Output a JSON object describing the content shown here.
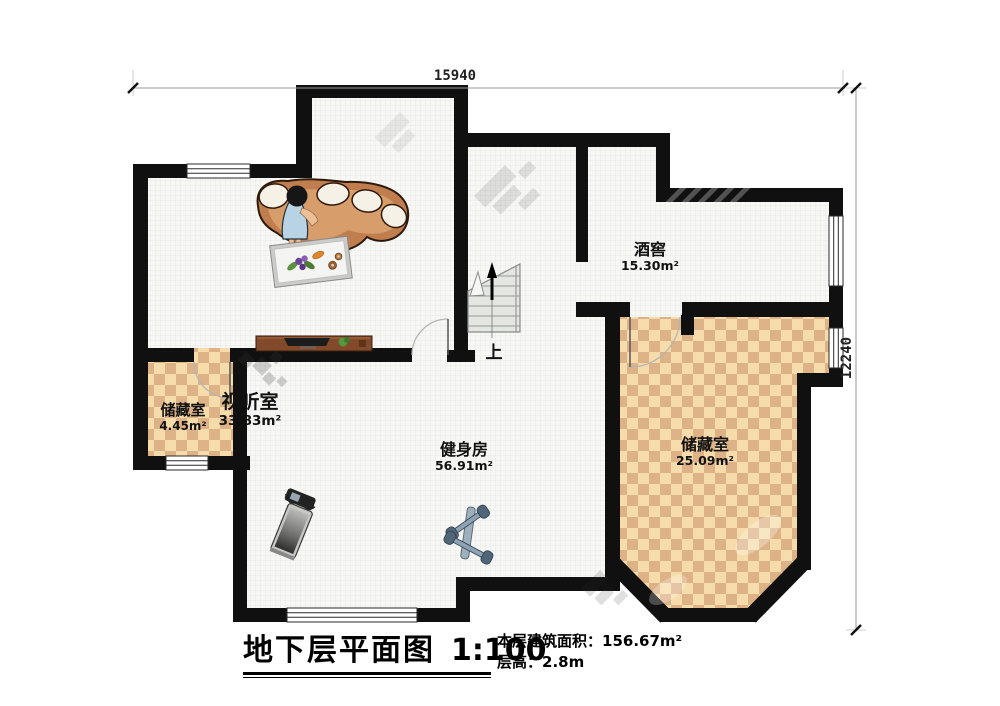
{
  "plan": {
    "dimension_top": "15940",
    "dimension_right": "12240",
    "stairs_direction_label": "上",
    "rooms": [
      {
        "name": "视听室",
        "area": "33.83m²"
      },
      {
        "name": "酒窖",
        "area": "15.30m²"
      },
      {
        "name": "储藏室",
        "area": "4.45m²"
      },
      {
        "name": "健身房",
        "area": "56.91m²"
      },
      {
        "name": "储藏室",
        "area": "25.09m²"
      }
    ]
  },
  "title_block": {
    "title": "地下层平面图",
    "scale": "1:100",
    "floor_area_label": "本层建筑面积：",
    "floor_area_value": "156.67m²",
    "floor_height_label": "层高：",
    "floor_height_value": "2.8m"
  },
  "colors": {
    "wall": "#101010",
    "checker_light": "#f6dcab",
    "checker_dark": "#ddb286",
    "floor_base": "#f7f7f5",
    "sofa": "#c07e4f",
    "dress_blue": "#b7d3e4"
  }
}
